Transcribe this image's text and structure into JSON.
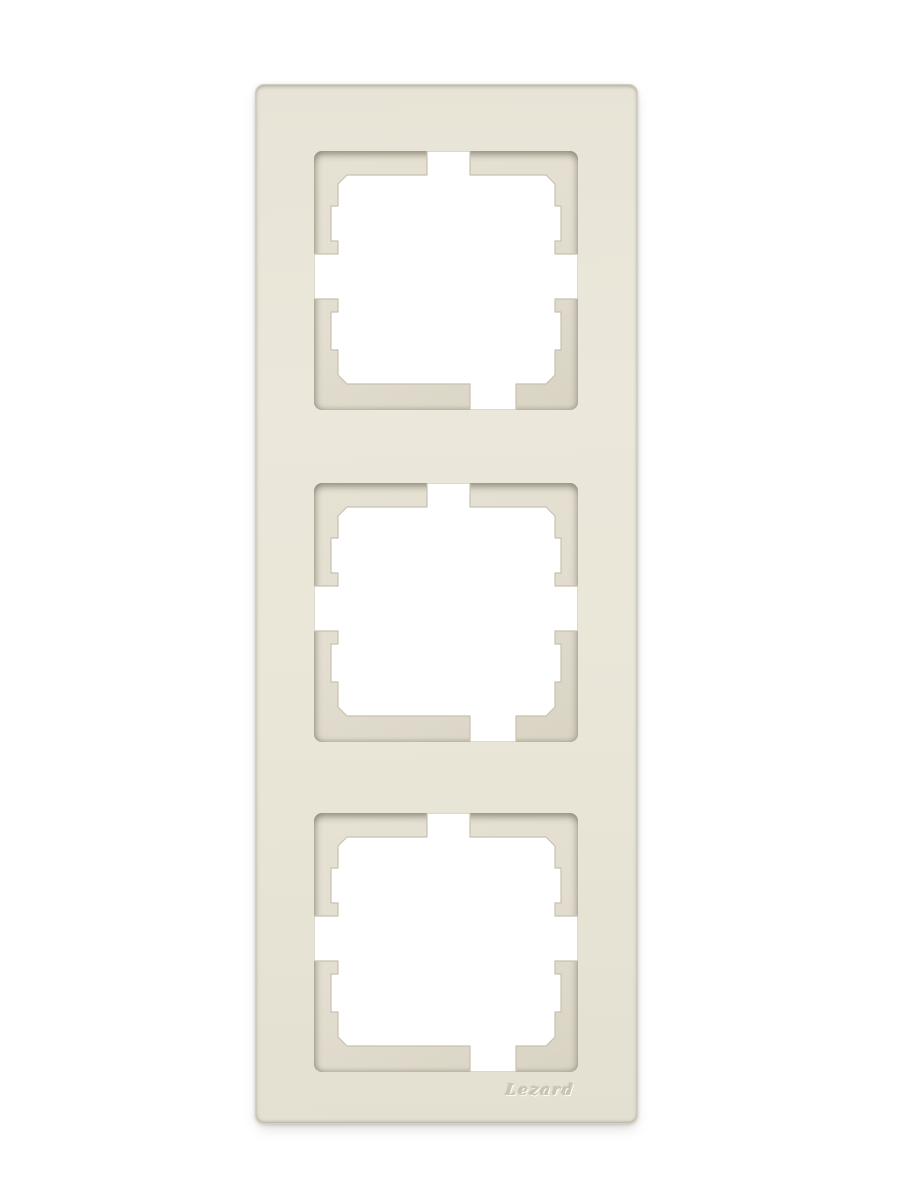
{
  "meta": {
    "description": "Product photograph of a cream ivory vertical 3-gang wall switch and socket frame on a plain white background"
  },
  "canvas": {
    "background_color": "#ffffff"
  },
  "product": {
    "brand_logo": "Lezard",
    "type": "3-gang wall switch frame",
    "orientation": "vertical",
    "gang_count": 3,
    "colors": {
      "frame_face": "#e9e5d8",
      "frame_edge_line": "#cdc9bd",
      "recess_ledge": "#e2ddce",
      "recess_shadow": "#6f6856",
      "cutout_hole": "#ffffff",
      "logo_emboss": "#cbc5b3",
      "drop_shadow": "#96938a"
    },
    "windows": [
      {
        "id": "module-window-1"
      },
      {
        "id": "module-window-2"
      },
      {
        "id": "module-window-3"
      }
    ]
  }
}
